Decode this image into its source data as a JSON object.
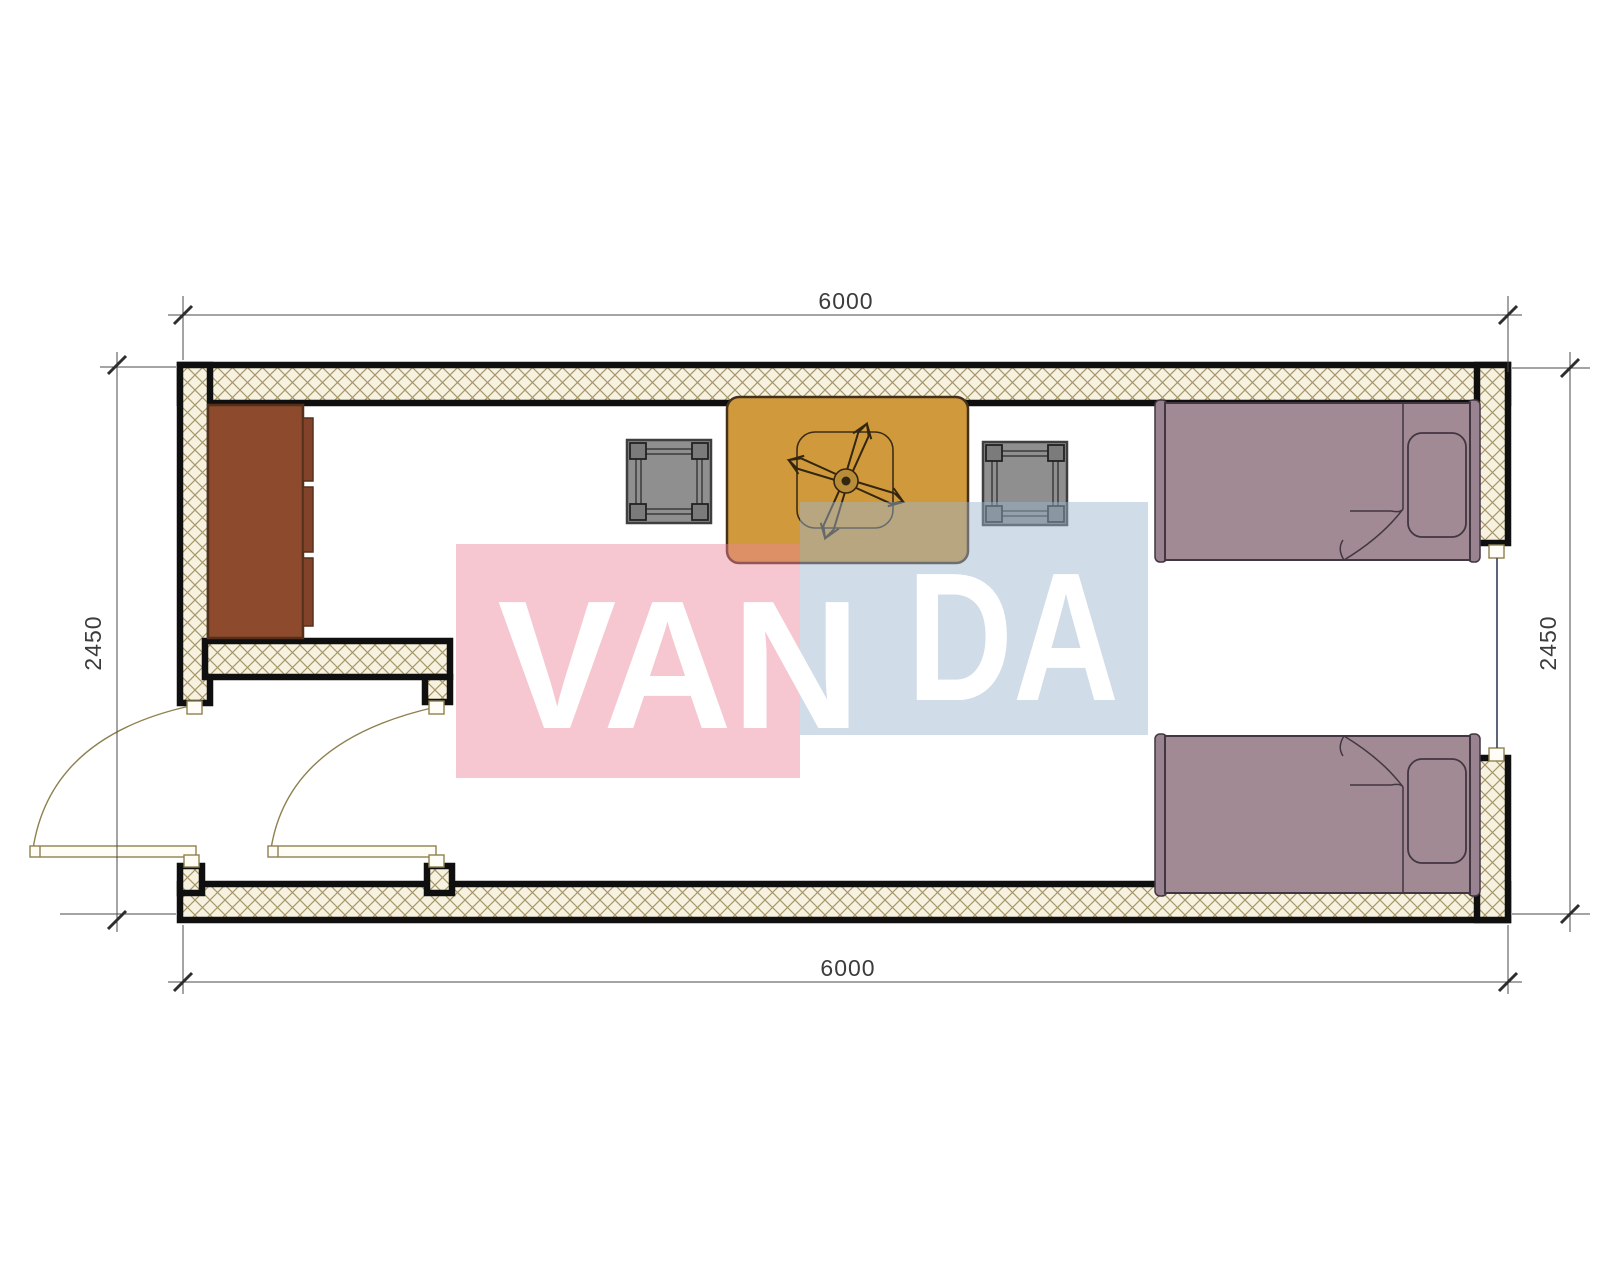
{
  "dimensions": {
    "top": "6000",
    "bottom": "6000",
    "left": "2450",
    "right": "2450"
  },
  "watermark": {
    "word": "VANDA",
    "left_part": "VAN",
    "right_part": "DA"
  },
  "furniture": [
    "wardrobe-cabinet",
    "table-with-ceiling-fan",
    "stool-left",
    "stool-right",
    "single-bed-top",
    "single-bed-bottom"
  ],
  "openings": [
    "entry-door-left-wall",
    "interior-door-vestibule",
    "window-right-wall"
  ],
  "colors": {
    "wall-line": "#0f0f0f",
    "hatch-bg": "#f7f1e0",
    "hatch-line": "#a59769",
    "door": "#8f8050",
    "window": "#3f4b63",
    "cabinet": "#8d4a2c",
    "cabinet-dark": "#82432a",
    "table": "#d09a3c",
    "stool": "#8f8f8f",
    "stool-dark": "#7b7b7b",
    "bed": "#a28a94",
    "bed-bar": "#998391",
    "bed-line": "#413641",
    "wm-pink": "#ee8298",
    "wm-blue": "#9db4d1",
    "dim-line": "#4a4a4a",
    "dim-text": "#3c3c3c"
  }
}
